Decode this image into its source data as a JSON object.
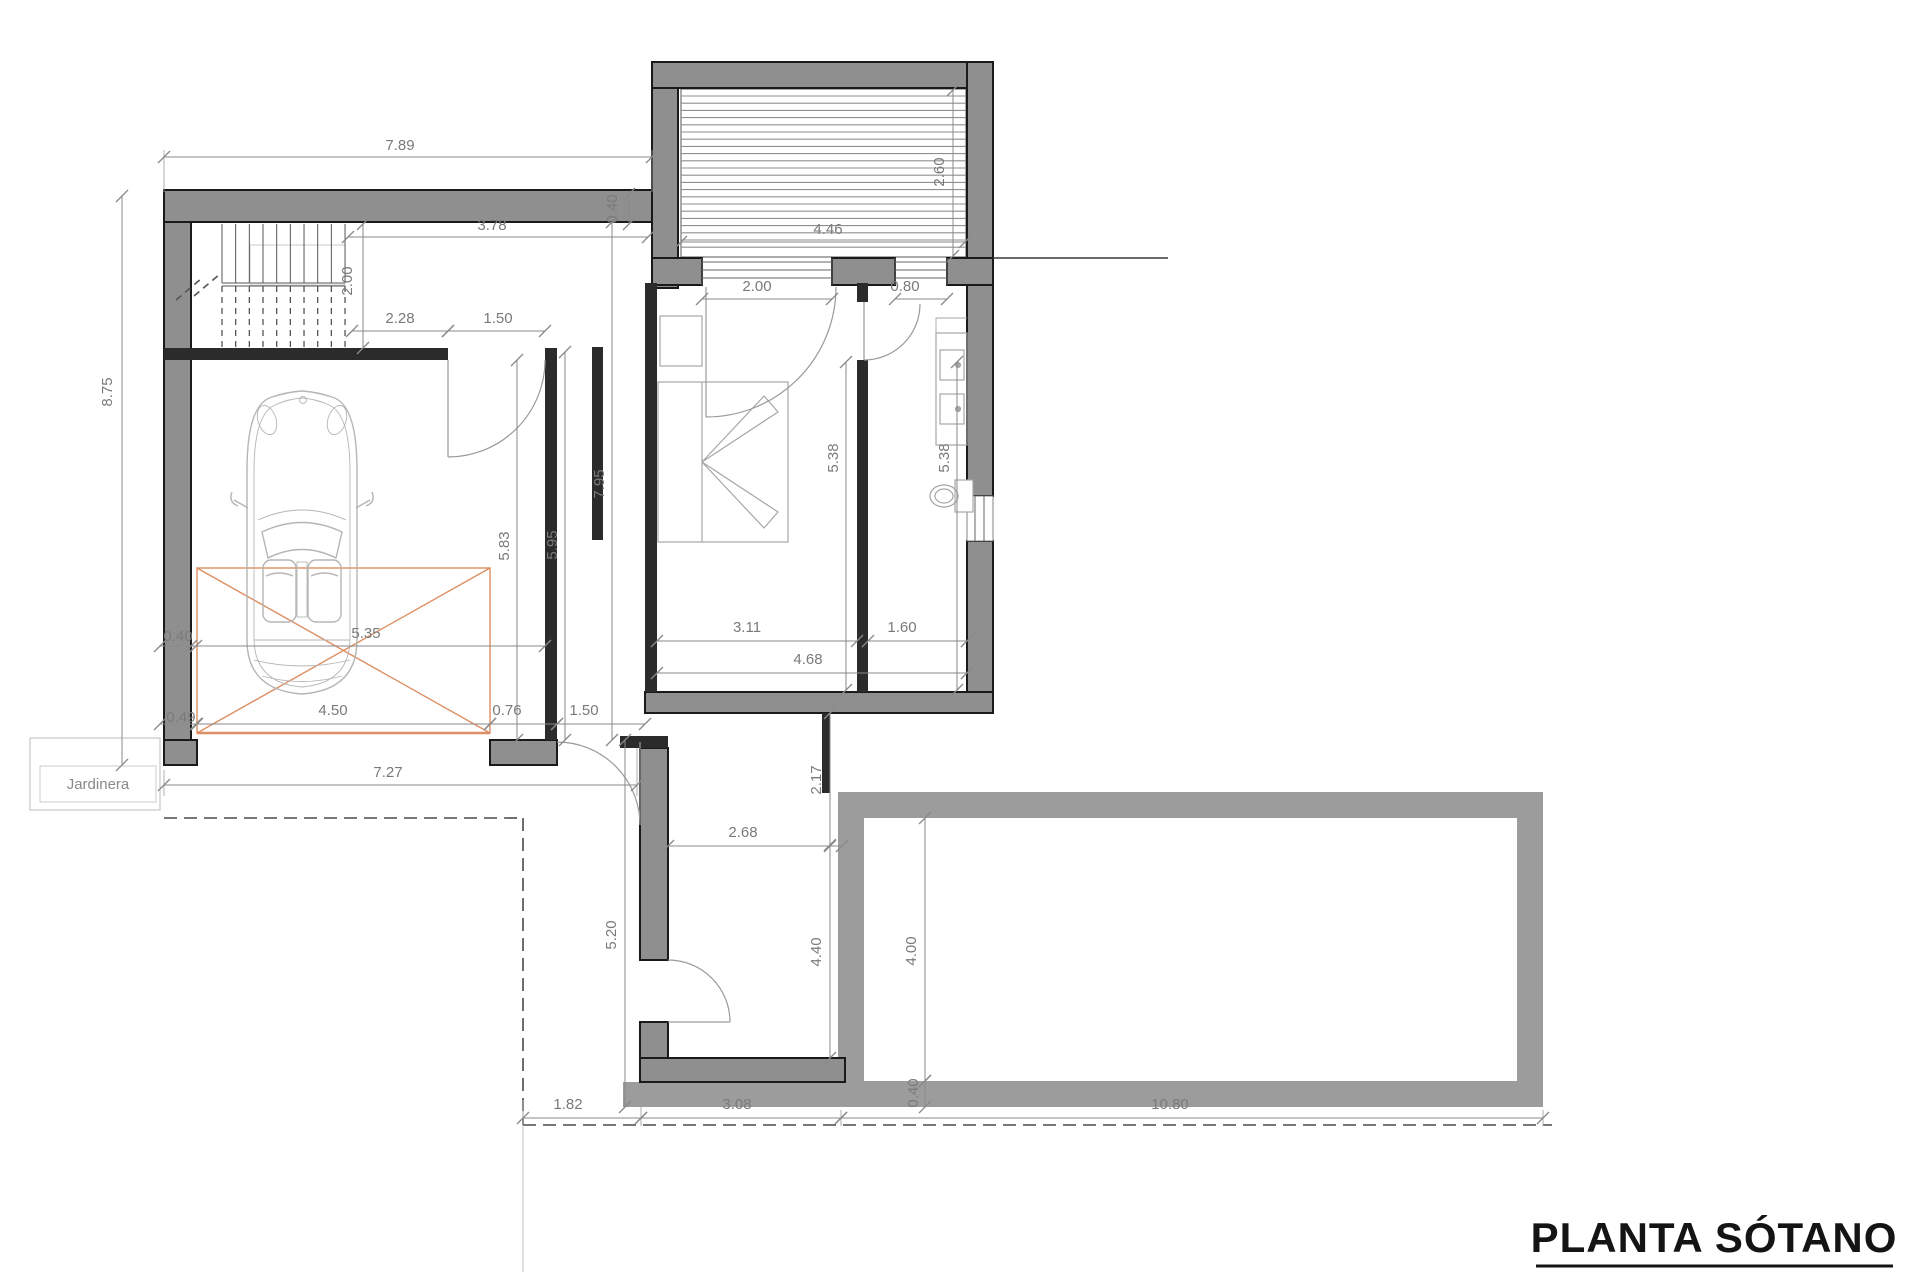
{
  "title": {
    "label": "PLANTA SÓTANO"
  },
  "labels": {
    "jardinera": "Jardinera"
  },
  "colors": {
    "wall_fill": "#8f8f8f",
    "wall_edge": "#1a1a1a",
    "thin_wall": "#2b2b2b",
    "pool_wall": "#9c9c9c",
    "dim_line": "#8a8a8a",
    "dim_text": "#7a7a7a",
    "fixture_stroke": "#a6a6a6",
    "car_stroke": "#b5b5b5",
    "platform_orange": "#dd8e62",
    "hatch_line": "#8f8f8f",
    "boundary_dash": "#4a4a4a"
  },
  "dimensions": [
    {
      "id": "top-width",
      "label": "7.89",
      "x": 400,
      "y": 150,
      "rot": 0,
      "line": [
        164,
        157,
        652,
        157
      ]
    },
    {
      "id": "stair-to-shaft",
      "label": "3.78",
      "x": 492,
      "y": 230,
      "rot": 0,
      "line": [
        348,
        237,
        648,
        237
      ]
    },
    {
      "id": "stair-width",
      "label": "2.00",
      "x": 352,
      "y": 281,
      "rot": -90,
      "line": [
        363,
        224,
        363,
        348
      ]
    },
    {
      "id": "hall-a",
      "label": "2.28",
      "x": 400,
      "y": 323,
      "rot": 0,
      "line": [
        352,
        331,
        448,
        331
      ]
    },
    {
      "id": "hall-opening",
      "label": "1.50",
      "x": 498,
      "y": 323,
      "rot": 0,
      "line": [
        448,
        331,
        545,
        331
      ]
    },
    {
      "id": "shaft-width",
      "label": "4.46",
      "x": 828,
      "y": 234,
      "rot": 0,
      "line": [
        681,
        242,
        965,
        242
      ]
    },
    {
      "id": "shaft-depth",
      "label": "2.60",
      "x": 944,
      "y": 172,
      "rot": -90,
      "line": [
        953,
        90,
        953,
        256
      ]
    },
    {
      "id": "wall-thk-top",
      "label": "0.40",
      "x": 617,
      "y": 209,
      "rot": -90,
      "line": [
        629,
        194,
        629,
        224
      ]
    },
    {
      "id": "bedroom-window",
      "label": "2.00",
      "x": 757,
      "y": 291,
      "rot": 0,
      "line": [
        702,
        299,
        832,
        299
      ]
    },
    {
      "id": "bath-window",
      "label": "0.80",
      "x": 905,
      "y": 291,
      "rot": 0,
      "line": [
        895,
        299,
        947,
        299
      ]
    },
    {
      "id": "corridor-length",
      "label": "7.95",
      "x": 604,
      "y": 484,
      "rot": -90,
      "line": [
        612,
        222,
        612,
        740
      ]
    },
    {
      "id": "garage-wall-length",
      "label": "5.95",
      "x": 557,
      "y": 545,
      "rot": -90,
      "line": [
        565,
        352,
        565,
        740
      ]
    },
    {
      "id": "garage-depth",
      "label": "5.83",
      "x": 509,
      "y": 546,
      "rot": -90,
      "line": [
        517,
        360,
        517,
        740
      ]
    },
    {
      "id": "bedroom-depth",
      "label": "5.38",
      "x": 838,
      "y": 458,
      "rot": -90,
      "line": [
        846,
        362,
        846,
        690
      ]
    },
    {
      "id": "bathroom-depth",
      "label": "5.38",
      "x": 949,
      "y": 458,
      "rot": -90,
      "line": [
        957,
        362,
        957,
        690
      ]
    },
    {
      "id": "left-height",
      "label": "8.75",
      "x": 112,
      "y": 392,
      "rot": -90,
      "line": [
        122,
        196,
        122,
        765
      ]
    },
    {
      "id": "wall-thk-left-a",
      "label": "0.40",
      "x": 178,
      "y": 641,
      "rot": 0,
      "line": [
        160,
        646,
        196,
        646
      ]
    },
    {
      "id": "platform-diag",
      "label": "5.35",
      "x": 366,
      "y": 638,
      "rot": 0,
      "line": [
        191,
        646,
        545,
        646
      ]
    },
    {
      "id": "wall-thk-left-b",
      "label": "0.49",
      "x": 181,
      "y": 722,
      "rot": 0,
      "line": [
        160,
        724,
        196,
        724
      ]
    },
    {
      "id": "platform-width",
      "label": "4.50",
      "x": 333,
      "y": 715,
      "rot": 0,
      "line": [
        197,
        724,
        490,
        724
      ]
    },
    {
      "id": "pillar-width",
      "label": "0.76",
      "x": 507,
      "y": 715,
      "rot": 0,
      "line": [
        490,
        724,
        557,
        724
      ]
    },
    {
      "id": "corridor-door",
      "label": "1.50",
      "x": 584,
      "y": 715,
      "rot": 0,
      "line": [
        557,
        724,
        645,
        724
      ]
    },
    {
      "id": "garage-front",
      "label": "7.27",
      "x": 388,
      "y": 777,
      "rot": 0,
      "line": [
        164,
        785,
        637,
        785
      ]
    },
    {
      "id": "bedroom-width",
      "label": "3.11",
      "x": 747,
      "y": 632,
      "rot": 0,
      "line": [
        657,
        641,
        857,
        641
      ]
    },
    {
      "id": "bathroom-width",
      "label": "1.60",
      "x": 902,
      "y": 632,
      "rot": 0,
      "line": [
        868,
        641,
        967,
        641
      ]
    },
    {
      "id": "rooms-width",
      "label": "4.68",
      "x": 808,
      "y": 664,
      "rot": 0,
      "line": [
        657,
        673,
        967,
        673
      ]
    },
    {
      "id": "terrace-depth",
      "label": "2.17",
      "x": 821,
      "y": 780,
      "rot": -90,
      "line": [
        830,
        713,
        830,
        845
      ]
    },
    {
      "id": "patio-width",
      "label": "2.68",
      "x": 743,
      "y": 837,
      "rot": 0,
      "line": [
        668,
        846,
        842,
        846
      ]
    },
    {
      "id": "patio-depth",
      "label": "4.40",
      "x": 821,
      "y": 952,
      "rot": -90,
      "line": [
        830,
        846,
        830,
        1058
      ]
    },
    {
      "id": "store-depth",
      "label": "5.20",
      "x": 616,
      "y": 935,
      "rot": -90,
      "line": [
        625,
        740,
        625,
        1107
      ]
    },
    {
      "id": "pool-depth",
      "label": "4.00",
      "x": 916,
      "y": 951,
      "rot": -90,
      "line": [
        925,
        818,
        925,
        1081
      ]
    },
    {
      "id": "pool-wall-thk",
      "label": "0.40",
      "x": 918,
      "y": 1093,
      "rot": -90,
      "line": [
        925,
        1081,
        925,
        1107
      ]
    },
    {
      "id": "bottom-a",
      "label": "1.82",
      "x": 568,
      "y": 1109,
      "rot": 0,
      "line": [
        523,
        1118,
        641,
        1118
      ]
    },
    {
      "id": "bottom-b",
      "label": "3.08",
      "x": 737,
      "y": 1109,
      "rot": 0,
      "line": [
        641,
        1118,
        841,
        1118
      ]
    },
    {
      "id": "bottom-c",
      "label": "10.80",
      "x": 1170,
      "y": 1109,
      "rot": 0,
      "line": [
        841,
        1118,
        1543,
        1118
      ]
    }
  ]
}
